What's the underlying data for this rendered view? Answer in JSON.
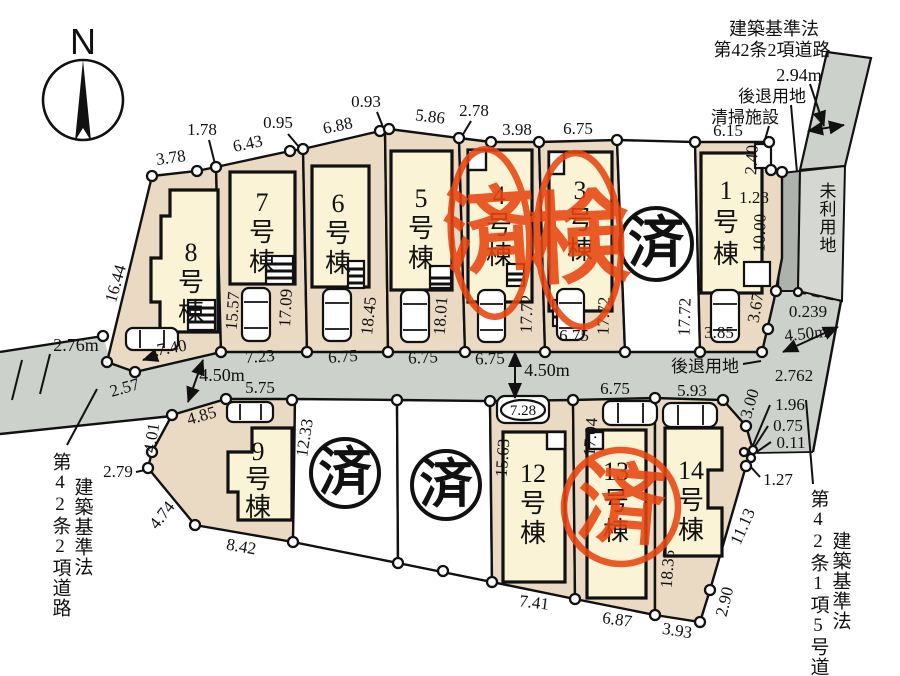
{
  "compass": {
    "label": "N"
  },
  "annotations": {
    "top_road_1": "建築基準法",
    "top_road_2": "第42条2項道路",
    "top_road_width": "2.94m",
    "setback_top": "後退用地",
    "cleaning_facility": "清掃施設",
    "unused_land": "未利用地",
    "setback_mid": "後退用地",
    "left_road_name": "第42条2項道路",
    "left_road_law": "建築基準法",
    "right_road_name": "第42条1項5号道路",
    "right_road_law": "建築基準法"
  },
  "stamps": {
    "lot2": "済",
    "lot3": "検",
    "lot4": "済",
    "lot10": "済",
    "lot11": "済",
    "lot13": "済"
  },
  "buildings": {
    "b1": {
      "num": "1",
      "s1": "号",
      "s2": "棟"
    },
    "b3": {
      "num": "3",
      "s1": "号",
      "s2": "棟"
    },
    "b4": {
      "num": "4",
      "s1": "号",
      "s2": "棟"
    },
    "b5": {
      "num": "5",
      "s1": "号",
      "s2": "棟"
    },
    "b6": {
      "num": "6",
      "s1": "号",
      "s2": "棟"
    },
    "b7": {
      "num": "7",
      "s1": "号",
      "s2": "棟"
    },
    "b8": {
      "num": "8",
      "s1": "号",
      "s2": "棟"
    },
    "b9": {
      "num": "9",
      "s1": "号",
      "s2": "棟"
    },
    "b12": {
      "num": "12",
      "s1": "号",
      "s2": "棟"
    },
    "b13": {
      "num": "13",
      "s1": "号",
      "s2": "棟"
    },
    "b14": {
      "num": "14",
      "s1": "号",
      "s2": "棟"
    }
  },
  "dims": {
    "t378": "3.78",
    "t178": "1.78",
    "t643": "6.43",
    "t095": "0.95",
    "t688": "6.88",
    "t093": "0.93",
    "t586": "5.86",
    "t278": "2.78",
    "t398": "3.98",
    "t675_3top": "6.75",
    "t615": "6.15",
    "r240": "2.40",
    "r128": "1.28",
    "r1000": "10.00",
    "r367": "3.67",
    "r385": "3.85",
    "v1644": "16.44",
    "v1557": "15.57",
    "v1709": "17.09",
    "v1845": "18.45",
    "v1801": "18.01",
    "v1772a": "17.72",
    "v1772b": "17.72",
    "v1772c": "17.72",
    "b740": "7.40",
    "b723": "7.23",
    "b675a": "6.75",
    "b675b": "6.75",
    "b675c": "6.75",
    "b675in3": "6.75",
    "w276": "2.76m",
    "w257": "2.57",
    "w450L": "4.50m",
    "w450M": "4.50m",
    "w575": "5.75",
    "w485": "4.85",
    "w675_13": "6.75",
    "w593": "5.93",
    "rt0239": "0.239",
    "rt450": "4.50m",
    "rt2762": "2.762",
    "rt300": "3.00",
    "rt196": "1.96",
    "rt075": "0.75",
    "rt011": "0.11",
    "rt127": "1.27",
    "lo401": "4.01",
    "lo279": "2.79",
    "lo474": "4.74",
    "lo842": "8.42",
    "lo1233": "12.33",
    "lo1563": "15.63",
    "lo1704": "17.04",
    "lo1835": "18.35",
    "lo1113": "11.13",
    "lo290": "2.90",
    "lo393": "3.93",
    "lo687": "6.87",
    "lo741": "7.41",
    "car728": "7.28"
  }
}
